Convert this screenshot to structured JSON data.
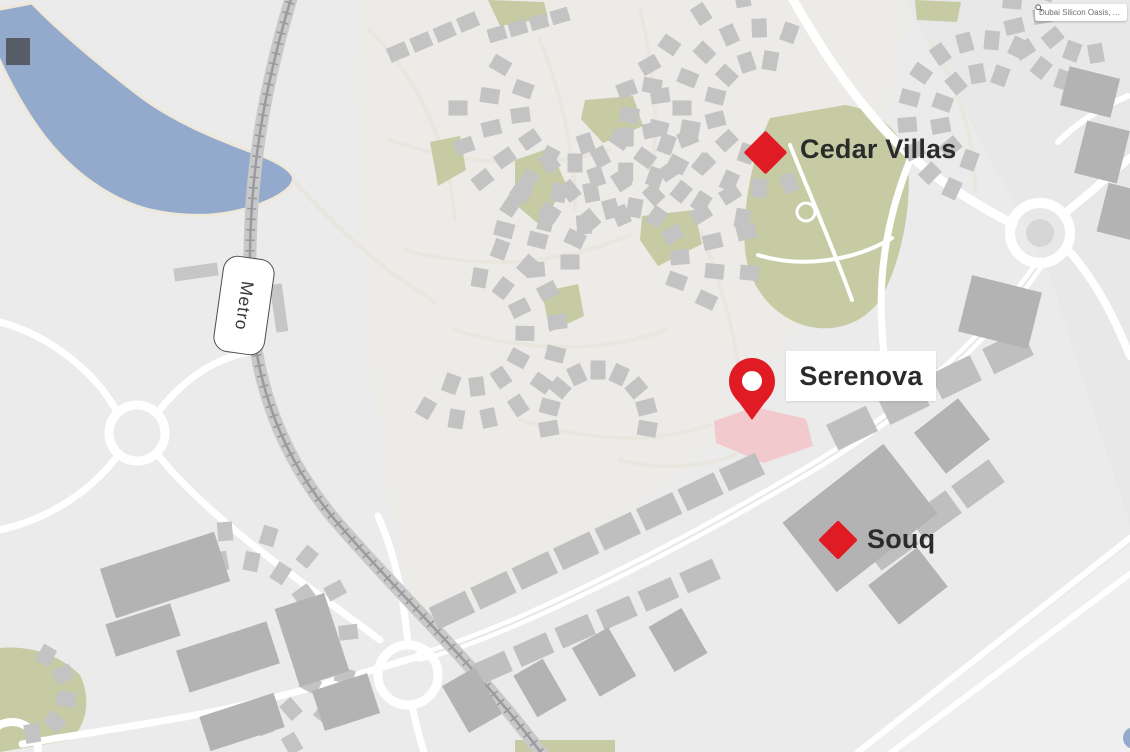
{
  "search": {
    "value": "Dubai Silicon Oasis, Axi...",
    "icon": "magnifier-icon"
  },
  "markers": {
    "cedar_villas": {
      "label": "Cedar Villas",
      "type": "diamond"
    },
    "serenova": {
      "label": "Serenova",
      "type": "pin"
    },
    "souq": {
      "label": "Souq",
      "type": "diamond"
    },
    "metro": {
      "label": "Metro",
      "type": "station-pill"
    }
  },
  "colors": {
    "marker_red": "#e11b23",
    "lake_blue": "#94aacd",
    "park_green": "#c6cba3",
    "plot_pink": "#f2c9cc",
    "bg": "#ebebeb",
    "label_ink": "#2b2b2b"
  }
}
